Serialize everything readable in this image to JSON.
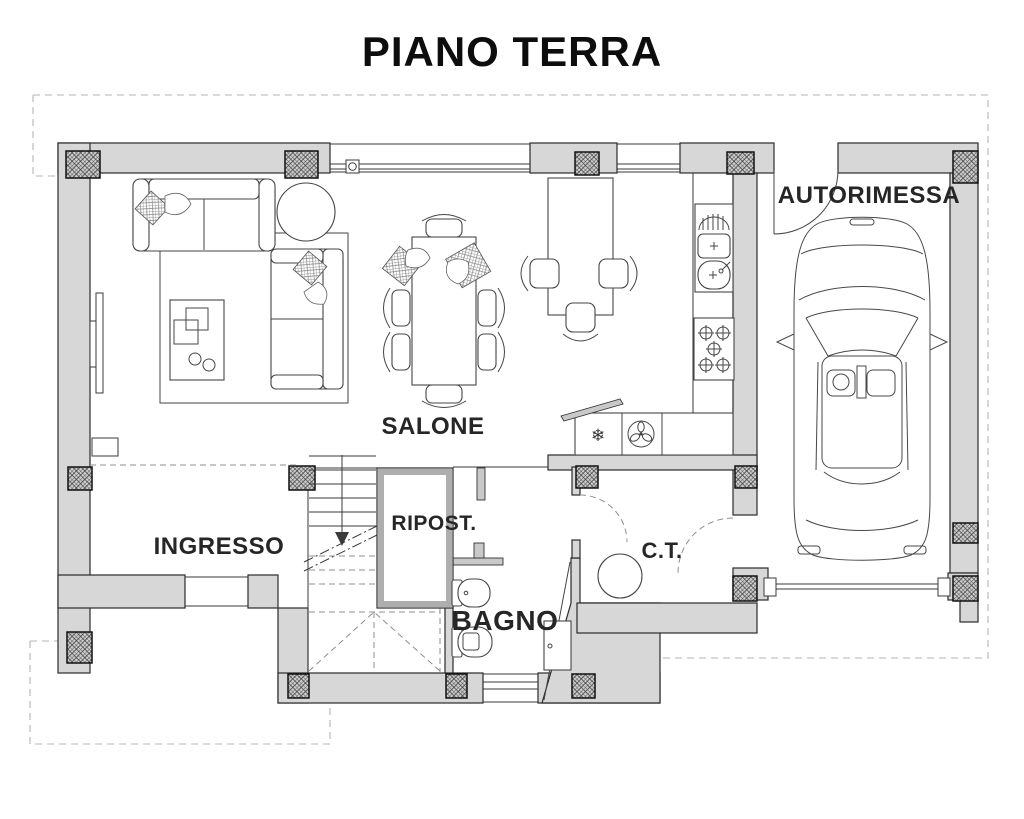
{
  "page": {
    "title": "PIANO TERRA"
  },
  "rooms": {
    "salone": "SALONE",
    "autorimessa": "AUTORIMESSA",
    "ingresso": "INGRESSO",
    "ripostiglio": "RIPOST.",
    "bagno": "BAGNO",
    "centrale_termica": "C.T."
  },
  "icons": {
    "freezer_glyph": "❄",
    "fan": "fan-icon",
    "gas_hob": "gas-hob-icon",
    "double_sink": "double-sink-icon"
  },
  "colors": {
    "wall": "#d7d7d7",
    "line": "#1c1c1c",
    "label": "#262626",
    "dash": "#b5b5b5"
  }
}
